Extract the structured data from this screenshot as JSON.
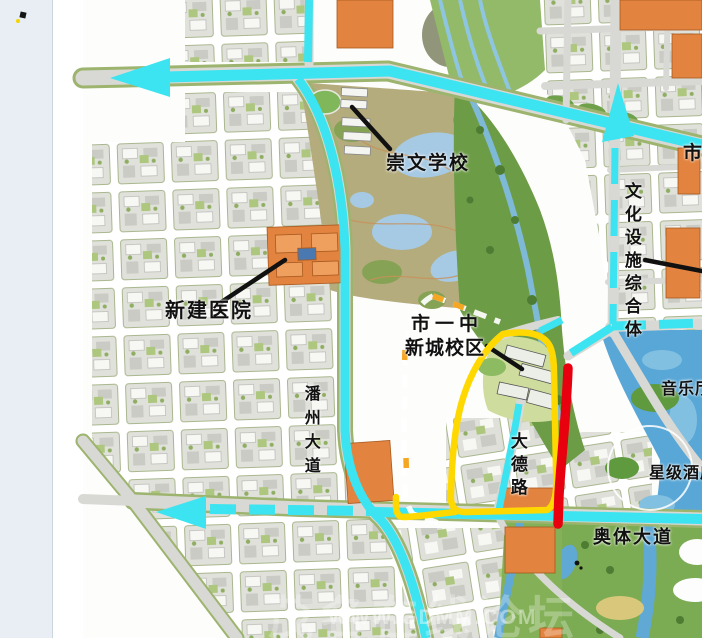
{
  "page": {
    "left_panel": {
      "icons": [
        "bullet-icon",
        "marker-dot-icon"
      ]
    }
  },
  "map": {
    "labels": {
      "chongwen_school": "崇文学校",
      "new_hospital": "新建医院",
      "city_no1_middle_line1": "市一中",
      "city_no1_middle_line2": "新城校区",
      "cultural_facilities_complex": "文化设施综合体",
      "city_label_cut": "市",
      "music_hall": "音乐厅",
      "star_hotel": "星级酒店",
      "aoti_avenue": "奥体大道",
      "panzhou_avenue": "潘州大道",
      "dade_road": "大德路"
    },
    "watermark": {
      "site_name": "茂名在线论坛",
      "site_url": "WWW.GDMM.COM"
    },
    "annotation_colors": {
      "planned_route_yellow": "#ffd800",
      "highlight_red": "#e8000f",
      "road_route_cyan": "#3be4f0",
      "boundary_white_dashed": "#ffffff",
      "boundary_orange_dashed": "#f5a623"
    }
  }
}
